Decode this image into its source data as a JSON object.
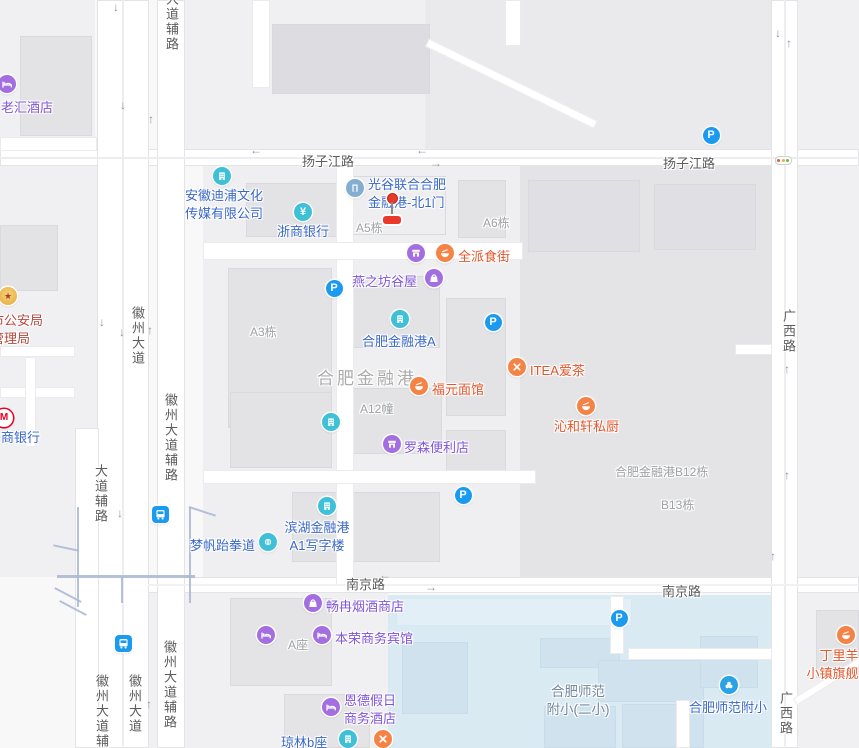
{
  "colors": {
    "teal": "#3fc0d6",
    "purple": "#a36fe0",
    "orange": "#f58345",
    "steel": "#84aed0",
    "school_blue": "#29a3e3",
    "gold": "#e9b445",
    "metro_red": "#e60021",
    "parking_blue": "#1a9bf0",
    "text_blue": "#3a68c8",
    "text_purple": "#8055d6",
    "text_orange": "#e2562b",
    "text_red": "#b5483d",
    "light_red": "#e45548",
    "light_yellow": "#f0a93c",
    "light_green": "#58bb4f"
  },
  "parking_letter": "P",
  "gate_marker": {
    "x": 392,
    "dot_y": 198,
    "stem_top": 202,
    "stem_h": 12,
    "bar_y": 216
  },
  "pois": [
    {
      "id": "laohui-hotel",
      "icon": "bed-icon",
      "icon_color": "purple",
      "text_color": "text_purple",
      "icon_x": 7,
      "icon_y": 84,
      "lines": [
        "老汇酒店"
      ],
      "align": "left",
      "text_x": 1,
      "text_y": 97
    },
    {
      "id": "anhui-dipu-media",
      "icon": "building-icon",
      "icon_color": "teal",
      "text_color": "text_blue",
      "icon_x": 222,
      "icon_y": 176,
      "lines": [
        "安徽迪浦文化",
        "传媒有限公司"
      ],
      "align": "left",
      "text_x": 185,
      "text_y": 185
    },
    {
      "id": "zheshang-bank",
      "icon": "yen-icon",
      "icon_color": "teal",
      "text_color": "text_blue",
      "icon_x": 303,
      "icon_y": 212,
      "lines": [
        "浙商银行"
      ],
      "align": "left",
      "text_x": 277,
      "text_y": 221
    },
    {
      "id": "guanggu-north-gate1",
      "icon": "door-icon",
      "icon_color": "steel",
      "text_color": "text_blue",
      "icon_x": 355,
      "icon_y": 188,
      "lines": [
        "光谷联合合肥",
        "金融港-北1门"
      ],
      "align": "left",
      "text_x": 368,
      "text_y": 174
    },
    {
      "id": "7tt-fresh-store",
      "icon": "store-icon",
      "icon_color": "purple",
      "text_color": "text_purple",
      "icon_x": 416,
      "icon_y": 253,
      "lines": [
        "7TT鲜食便利"
      ],
      "align": "right",
      "text_x": 407,
      "text_y": 246
    },
    {
      "id": "quanpai-food-street",
      "icon": "bowl-icon",
      "icon_color": "orange",
      "text_color": "text_orange",
      "icon_x": 445,
      "icon_y": 253,
      "lines": [
        "全派食街"
      ],
      "align": "left",
      "text_x": 458,
      "text_y": 246
    },
    {
      "id": "yanzhifang-guwu",
      "icon": "bag-icon",
      "icon_color": "purple",
      "text_color": "text_purple",
      "icon_x": 434,
      "icon_y": 278,
      "lines": [
        "燕之坊谷屋"
      ],
      "align": "left",
      "text_x": 352,
      "text_y": 271
    },
    {
      "id": "hefei-jinronggang-a",
      "icon": "building-icon",
      "icon_color": "teal",
      "text_color": "text_blue",
      "icon_x": 400,
      "icon_y": 319,
      "lines": [
        "合肥金融港A"
      ],
      "align": "left",
      "text_x": 362,
      "text_y": 331
    },
    {
      "id": "itea-tea",
      "icon": "utensils-icon",
      "icon_color": "orange",
      "text_color": "text_orange",
      "icon_x": 517,
      "icon_y": 367,
      "lines": [
        "ITEA爱茶"
      ],
      "align": "left",
      "text_x": 530,
      "text_y": 360
    },
    {
      "id": "fuyuan-noodle",
      "icon": "bowl-icon",
      "icon_color": "orange",
      "text_color": "text_orange",
      "icon_x": 419,
      "icon_y": 386,
      "lines": [
        "福元面馆"
      ],
      "align": "left",
      "text_x": 432,
      "text_y": 379
    },
    {
      "id": "qinhexuan-kitchen",
      "icon": "bowl-icon",
      "icon_color": "orange",
      "text_color": "text_orange",
      "icon_x": 586,
      "icon_y": 406,
      "lines": [
        "沁和轩私厨"
      ],
      "align": "left",
      "text_x": 554,
      "text_y": 416
    },
    {
      "id": "a2-office-tower",
      "icon": "building-icon",
      "icon_color": "teal",
      "text_color": "text_blue",
      "icon_x": 331,
      "icon_y": 422,
      "lines": [
        "包河区滨湖金融港",
        "a2写字楼"
      ],
      "align": "right",
      "text_x": 320,
      "text_y": 404
    },
    {
      "id": "lawson-store",
      "icon": "store-icon",
      "icon_color": "purple",
      "text_color": "text_purple",
      "icon_x": 392,
      "icon_y": 444,
      "lines": [
        "罗森便利店"
      ],
      "align": "left",
      "text_x": 404,
      "text_y": 437
    },
    {
      "id": "a1-office-tower",
      "icon": "building-icon",
      "icon_color": "teal",
      "text_color": "text_blue",
      "icon_x": 327,
      "icon_y": 506,
      "lines": [
        "滨湖金融港",
        "A1写字楼"
      ],
      "align": "center",
      "text_x": 317,
      "text_y": 517
    },
    {
      "id": "mengfan-taekwondo",
      "icon": "fist-icon",
      "icon_color": "teal",
      "text_color": "text_blue",
      "icon_x": 268,
      "icon_y": 542,
      "lines": [
        "梦帆跆拳道"
      ],
      "align": "left",
      "text_x": 190,
      "text_y": 535
    },
    {
      "id": "changran-tobacco",
      "icon": "bag-icon",
      "icon_color": "purple",
      "text_color": "text_purple",
      "icon_x": 313,
      "icon_y": 603,
      "lines": [
        "畅冉烟酒商店"
      ],
      "align": "left",
      "text_x": 326,
      "text_y": 596
    },
    {
      "id": "hefei-shijian-hotel",
      "icon": "bed-icon",
      "icon_color": "purple",
      "text_color": "text_purple",
      "icon_x": 266,
      "icon_y": 635,
      "lines": [
        "合肥拾间",
        "公寓酒店"
      ],
      "align": "right",
      "text_x": 255,
      "text_y": 618
    },
    {
      "id": "benrong-hotel",
      "icon": "bed-icon",
      "icon_color": "purple",
      "text_color": "text_purple",
      "icon_x": 322,
      "icon_y": 635,
      "lines": [
        "本荣商务宾馆"
      ],
      "align": "left",
      "text_x": 335,
      "text_y": 628
    },
    {
      "id": "ende-holiday-hotel",
      "icon": "bed-icon",
      "icon_color": "purple",
      "text_color": "text_purple",
      "icon_x": 331,
      "icon_y": 707,
      "lines": [
        "恩德假日",
        "商务酒店"
      ],
      "align": "left",
      "text_x": 344,
      "text_y": 690
    },
    {
      "id": "qionglin-b",
      "icon": "building-icon",
      "icon_color": "teal",
      "text_color": "text_blue",
      "icon_x": 348,
      "icon_y": 739,
      "lines": [
        "琼林b座"
      ],
      "align": "left",
      "text_x": 281,
      "text_y": 732
    },
    {
      "id": "qionglin-restaurant",
      "icon": "utensils-icon",
      "icon_color": "orange",
      "text_color": "text_orange",
      "icon_x": 383,
      "icon_y": 739,
      "lines": [],
      "align": "left",
      "text_x": 0,
      "text_y": 0
    },
    {
      "id": "shifan-fuxiao",
      "icon": "school-icon",
      "icon_color": "school_blue",
      "text_color": "text_blue",
      "icon_x": 729,
      "icon_y": 685,
      "lines": [
        "合肥师范附小"
      ],
      "align": "left",
      "text_x": 689,
      "text_y": 697
    },
    {
      "id": "dingliyang-flagship",
      "icon": "bowl-icon",
      "icon_color": "orange",
      "text_color": "text_orange",
      "icon_x": 846,
      "icon_y": 635,
      "lines": [
        "丁里羊",
        "小镇旗舰店"
      ],
      "align": "center",
      "text_x": 839,
      "text_y": 645
    },
    {
      "id": "police-bureau",
      "icon": "badge-icon",
      "icon_color": "gold",
      "text_color": "text_red",
      "icon_x": 8,
      "icon_y": 296,
      "lines": [
        "市公安局",
        "管理局"
      ],
      "align": "left",
      "text_x": -9,
      "text_y": 310
    },
    {
      "id": "huishang-bank",
      "icon": "metro-icon",
      "icon_color": "metro_red",
      "text_color": "text_blue",
      "icon_x": 4,
      "icon_y": 418,
      "lines": [
        "商银行"
      ],
      "align": "left",
      "text_x": 1,
      "text_y": 427
    }
  ],
  "road_labels": [
    {
      "text": "扬子江路",
      "x": 302,
      "y": 151,
      "vertical": false
    },
    {
      "text": "扬子江路",
      "x": 663,
      "y": 153,
      "vertical": false
    },
    {
      "text": "南京路",
      "x": 346,
      "y": 574,
      "vertical": false
    },
    {
      "text": "南京路",
      "x": 662,
      "y": 581,
      "vertical": false
    },
    {
      "text": "大道辅路",
      "x": 162,
      "y": -8,
      "vertical": true
    },
    {
      "text": "徽州大道",
      "x": 128,
      "y": 306,
      "vertical": true
    },
    {
      "text": "徽州大道辅路",
      "x": 161,
      "y": 393,
      "vertical": true
    },
    {
      "text": "大道辅路",
      "x": 91,
      "y": 464,
      "vertical": true
    },
    {
      "text": "徽州大道辅路",
      "x": 92,
      "y": 674,
      "vertical": true
    },
    {
      "text": "徽州大道",
      "x": 125,
      "y": 674,
      "vertical": true
    },
    {
      "text": "徽州大道辅路",
      "x": 160,
      "y": 640,
      "vertical": true
    },
    {
      "text": "广西路",
      "x": 779,
      "y": 309,
      "vertical": true
    },
    {
      "text": "广西路",
      "x": 776,
      "y": 691,
      "vertical": true
    }
  ],
  "building_labels": [
    {
      "text": "A5栋",
      "x": 356,
      "y": 219
    },
    {
      "text": "A6栋",
      "x": 483,
      "y": 214
    },
    {
      "text": "A3栋",
      "x": 250,
      "y": 323
    },
    {
      "text": "A12幢",
      "x": 360,
      "y": 400
    },
    {
      "text": "合肥金融港B12栋",
      "x": 615,
      "y": 463
    },
    {
      "text": "B13栋",
      "x": 661,
      "y": 496
    },
    {
      "text": "A座",
      "x": 288,
      "y": 636
    }
  ],
  "area_labels": {
    "big": {
      "text": "合肥金融港",
      "x": 317,
      "y": 364
    },
    "school": {
      "lines": [
        "合肥师范",
        "附小(二小)"
      ],
      "x": 578,
      "y": 680
    }
  },
  "arrows": [
    {
      "dir": "down",
      "x": 119,
      "y": 8
    },
    {
      "dir": "down",
      "x": 126,
      "y": 106
    },
    {
      "dir": "up",
      "x": 154,
      "y": 120
    },
    {
      "dir": "left",
      "x": 256,
      "y": 151
    },
    {
      "dir": "left",
      "x": 422,
      "y": 151
    },
    {
      "dir": "right",
      "x": 436,
      "y": 164
    },
    {
      "dir": "down",
      "x": 105,
      "y": 323
    },
    {
      "dir": "down",
      "x": 125,
      "y": 333
    },
    {
      "dir": "up",
      "x": 153,
      "y": 331
    },
    {
      "dir": "down",
      "x": 123,
      "y": 514
    },
    {
      "dir": "up",
      "x": 152,
      "y": 705
    },
    {
      "dir": "left",
      "x": 385,
      "y": 576
    },
    {
      "dir": "right",
      "x": 431,
      "y": 588
    },
    {
      "dir": "up",
      "x": 776,
      "y": 557
    },
    {
      "dir": "down",
      "x": 781,
      "y": 34
    },
    {
      "dir": "up",
      "x": 792,
      "y": 44
    },
    {
      "dir": "up",
      "x": 790,
      "y": 370
    },
    {
      "dir": "up",
      "x": 790,
      "y": 476
    }
  ],
  "parking_icons": [
    [
      711,
      135
    ],
    [
      334,
      288
    ],
    [
      493,
      322
    ],
    [
      463,
      495
    ],
    [
      619,
      618
    ]
  ],
  "bus_icons": [
    [
      160,
      514
    ],
    [
      123,
      643
    ]
  ],
  "traffic_lights": [
    [
      783,
      160
    ]
  ]
}
